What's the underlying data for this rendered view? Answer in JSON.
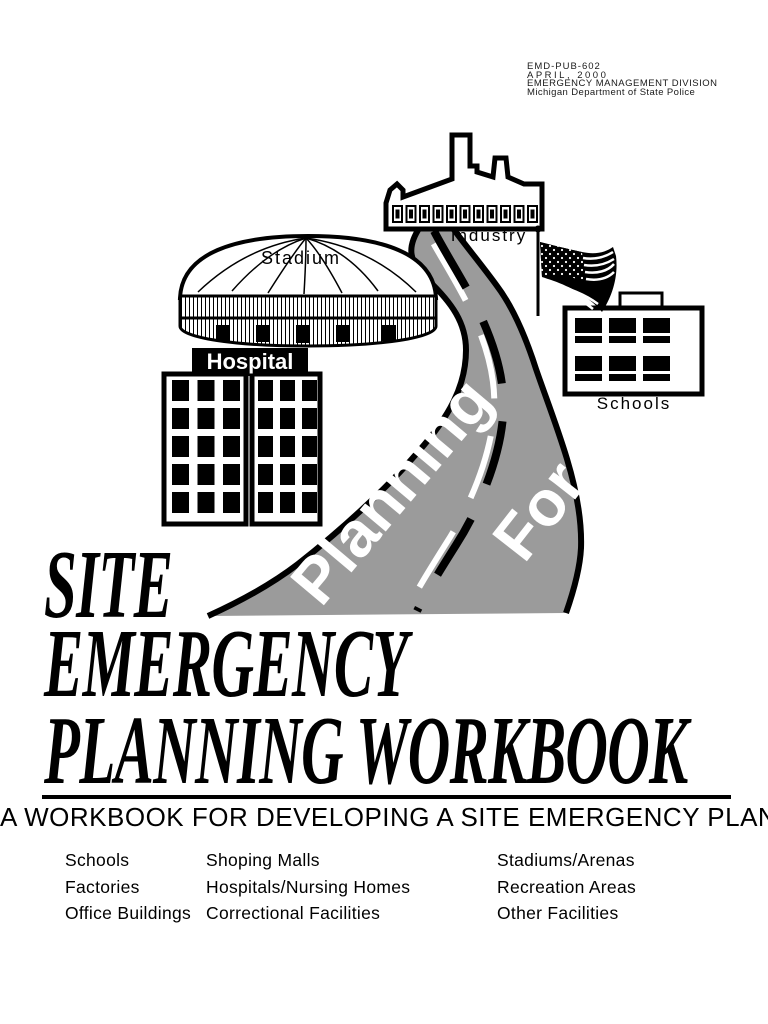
{
  "header": {
    "pub_number": "EMD-PUB-602",
    "date": "APRIL, 2000",
    "division": "EMERGENCY MANAGEMENT DIVISION",
    "agency": "Michigan Department of State Police"
  },
  "illustration": {
    "industry_label": "Industry",
    "stadium_label": "Stadium",
    "hospital_label": "Hospital",
    "schools_label": "Schools",
    "road_word1": "Planning",
    "road_word2": "For",
    "road_color": "#9b9b9b",
    "ink_color": "#000000"
  },
  "title": {
    "line1": "SITE",
    "line2": "EMERGENCY",
    "line3": "PLANNING WORKBOOK"
  },
  "subtitle": "A WORKBOOK FOR DEVELOPING A SITE EMERGENCY PLAN",
  "facilities": {
    "col1": [
      "Schools",
      "Factories",
      "Office Buildings"
    ],
    "col2": [
      "Shoping Malls",
      "Hospitals/Nursing Homes",
      "Correctional Facilities"
    ],
    "col3": [
      "Stadiums/Arenas",
      "Recreation Areas",
      "Other Facilities"
    ]
  }
}
